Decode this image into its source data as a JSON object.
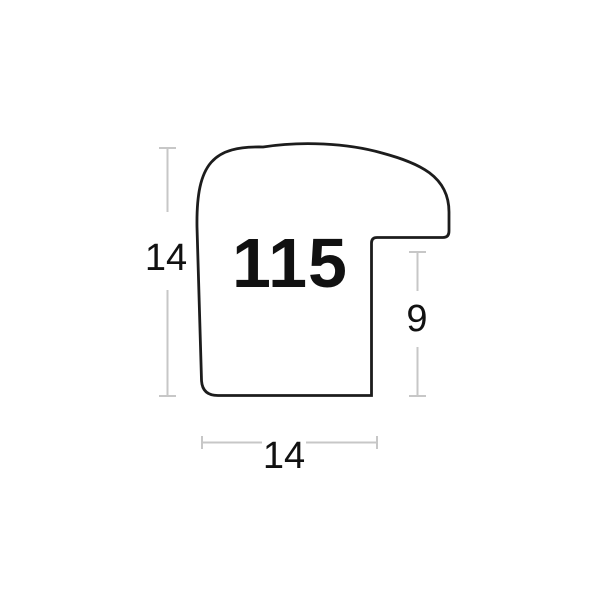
{
  "diagram": {
    "profile_label": "115",
    "dimension_labels": {
      "height": "14",
      "width": "14",
      "rabbet_height": "9"
    },
    "colors": {
      "outline": "#1c1c1c",
      "dimension_line": "#c7c7c7"
    }
  }
}
